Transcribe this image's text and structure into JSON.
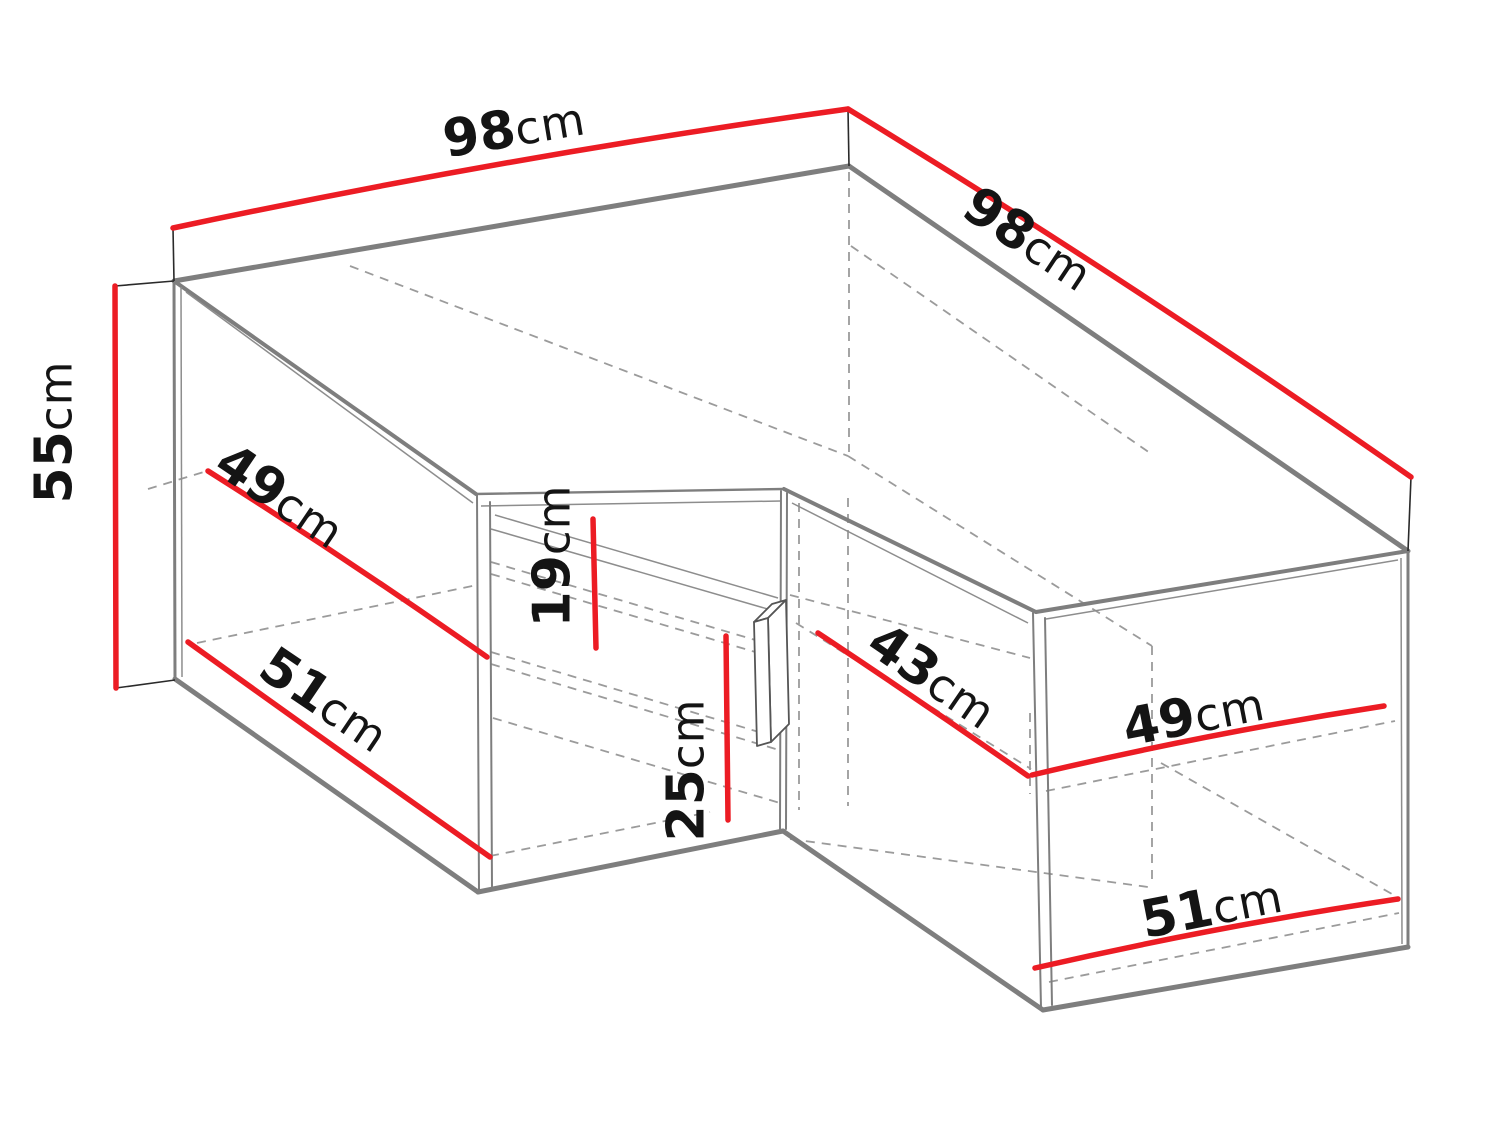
{
  "diagram": {
    "type": "furniture-dimension-diagram",
    "subject": "L-shaped corner wall cabinet, 3D wireframe view",
    "unit": "cm",
    "colors": {
      "dimension_line": "#ec1c24",
      "structure_edge": "#7e7e7e",
      "hidden_edge": "#9b9b9b",
      "label_text": "#141414",
      "background": "#ffffff"
    }
  },
  "dims": {
    "d98_left": {
      "value": "98",
      "unit": "cm",
      "meaning": "top back edge, left wing width"
    },
    "d98_right": {
      "value": "98",
      "unit": "cm",
      "meaning": "top back edge, right wing width"
    },
    "d55": {
      "value": "55",
      "unit": "cm",
      "meaning": "overall height"
    },
    "d49_left": {
      "value": "49",
      "unit": "cm",
      "meaning": "upper depth, left wing"
    },
    "d51_left": {
      "value": "51",
      "unit": "cm",
      "meaning": "lower depth, left wing"
    },
    "d19": {
      "value": "19",
      "unit": "cm",
      "meaning": "top section interior height"
    },
    "d25": {
      "value": "25",
      "unit": "cm",
      "meaning": "lower section interior height"
    },
    "d43": {
      "value": "43",
      "unit": "cm",
      "meaning": "inner front width, right section"
    },
    "d49_right": {
      "value": "49",
      "unit": "cm",
      "meaning": "mid shelf depth, right wing"
    },
    "d51_right": {
      "value": "51",
      "unit": "cm",
      "meaning": "bottom depth, right wing"
    }
  }
}
